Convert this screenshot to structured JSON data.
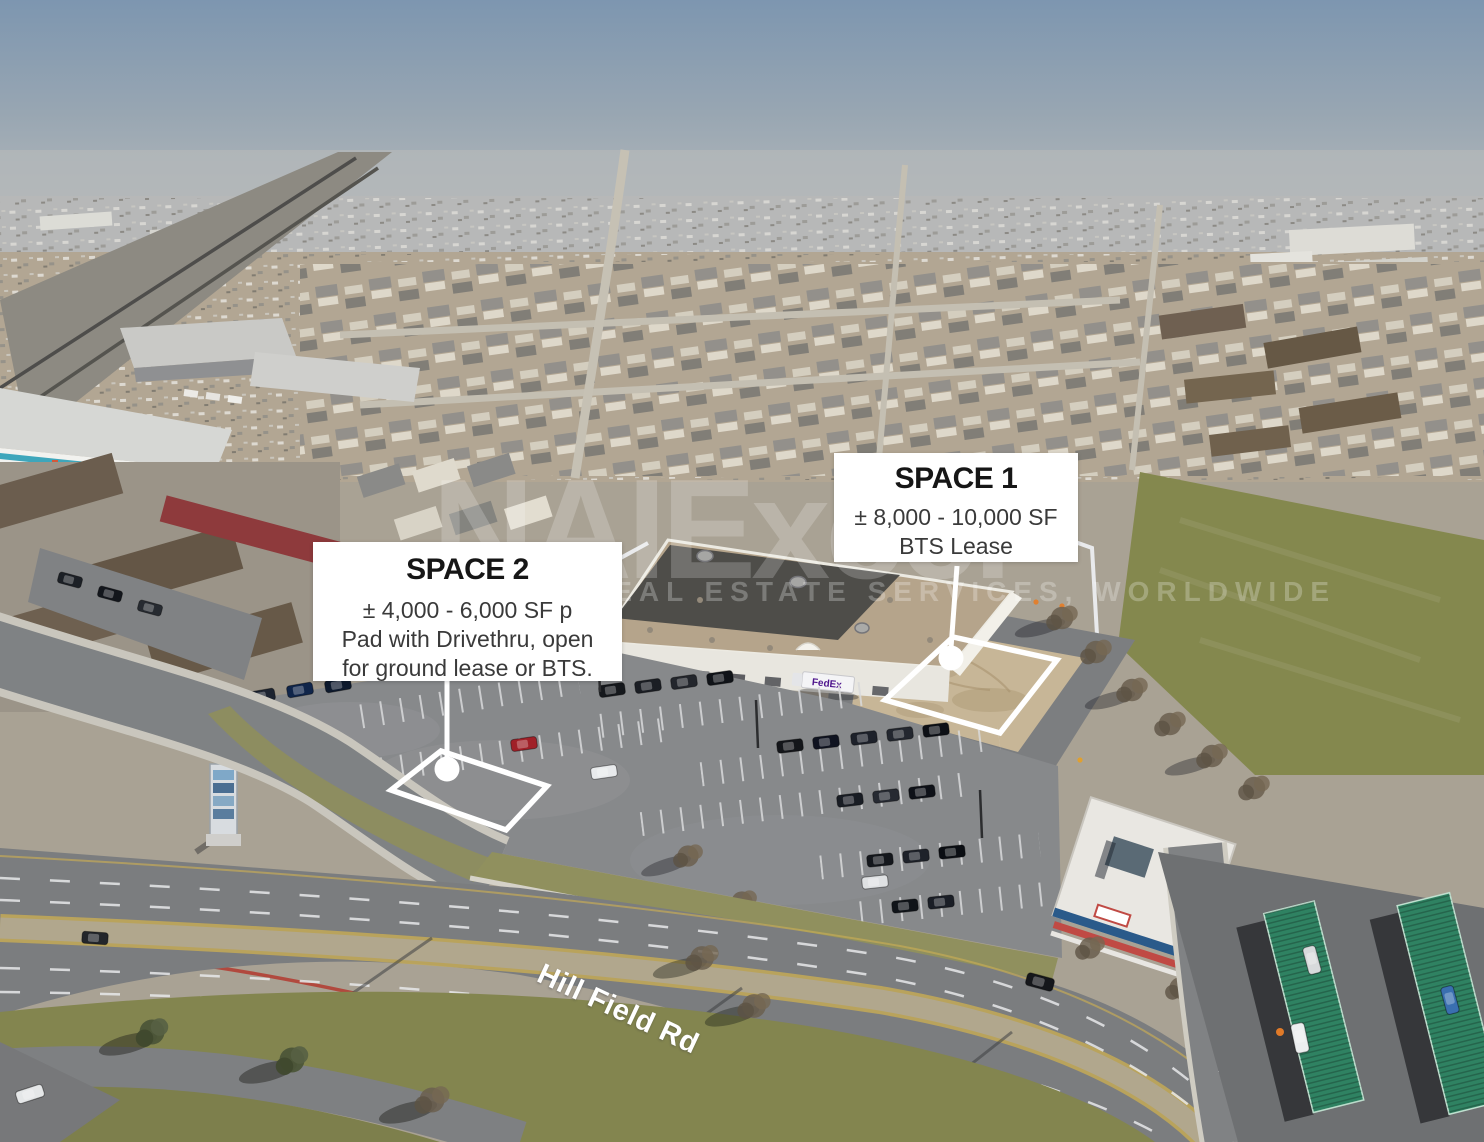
{
  "callouts": {
    "space1": {
      "title": "SPACE 1",
      "lines": [
        "± 8,000 - 10,000 SF",
        "BTS Lease"
      ]
    },
    "space2": {
      "title": "SPACE 2",
      "lines": [
        "± 4,000 - 6,000 SF p",
        "Pad with Drivethru, open",
        "for ground lease or BTS."
      ]
    }
  },
  "road_label": "Hill Field Rd",
  "watermark": {
    "brand": "NAIExcel",
    "tagline": "REAL ESTATE SERVICES, WORLDWIDE"
  },
  "scene": {
    "fedex_label": "FedEx",
    "palette": {
      "sky_top": "#7d96b0",
      "haze": "#b2b7ba",
      "city_tan": "#b2a693",
      "asphalt": "#87898b",
      "road": "#7b7d7f",
      "roof_tan": "#b5a48b",
      "roof_dark": "#454543",
      "dirt_pad": "#c7b697",
      "grass_olive": "#8f8e5c",
      "field_green": "#84884e",
      "canopy_green": "#2f8262",
      "carport_red": "#8e3a3c",
      "callout_white": "#ffffff",
      "outline_white": "#ffffff"
    }
  }
}
